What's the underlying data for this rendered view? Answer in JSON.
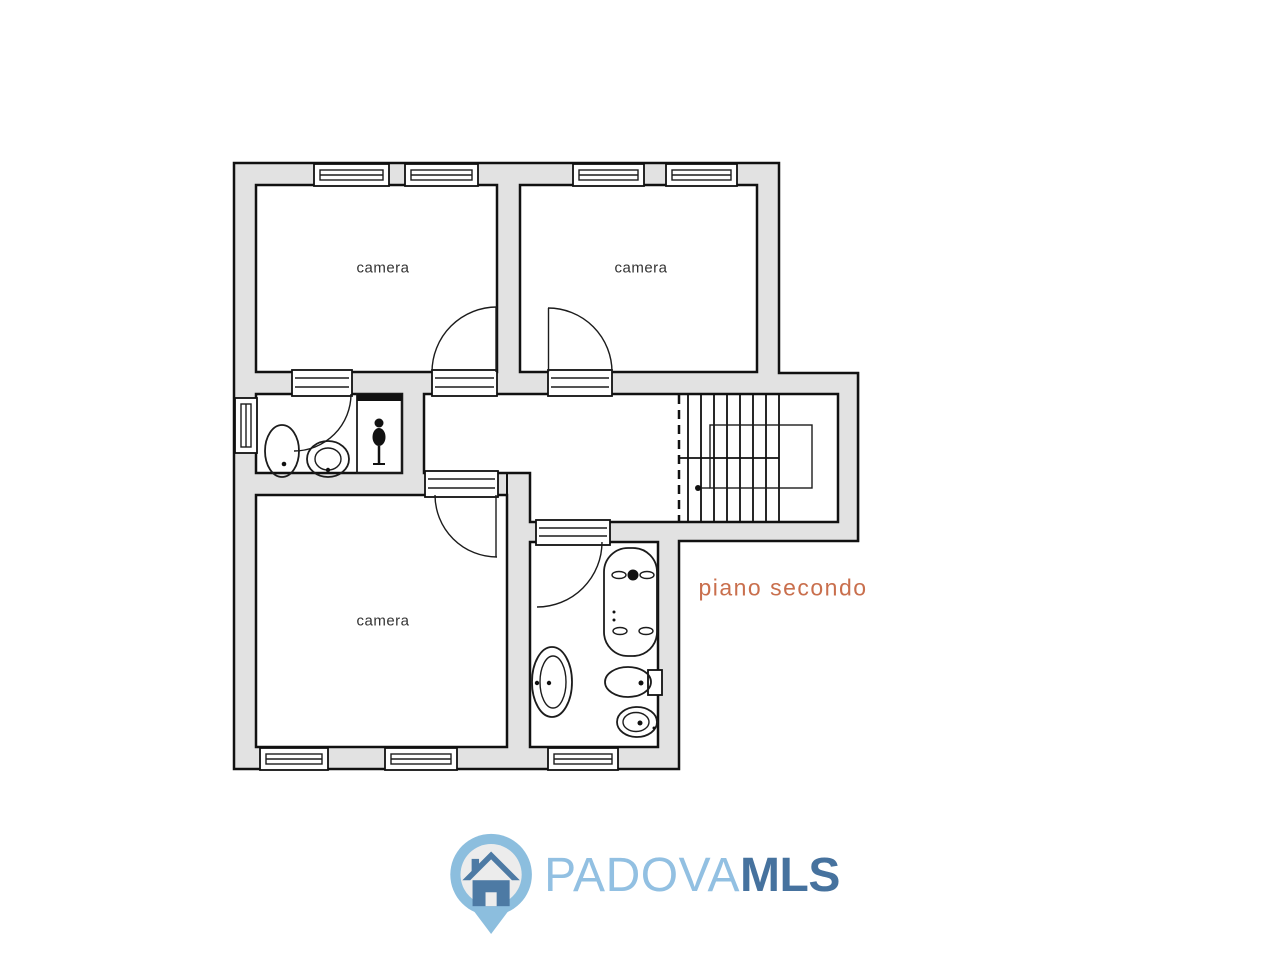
{
  "plan": {
    "floor_label": "piano secondo",
    "rooms": [
      {
        "name": "camera-top-left",
        "label": "camera"
      },
      {
        "name": "camera-top-right",
        "label": "camera"
      },
      {
        "name": "camera-bottom-left",
        "label": "camera"
      }
    ],
    "unlabeled_spaces": [
      "bathroom-top",
      "bathroom-bottom",
      "hallway",
      "staircase"
    ],
    "colors": {
      "wall_fill": "#e2e2e2",
      "outline": "#111111",
      "floor_label_color": "#c96f4d"
    }
  },
  "logo": {
    "brand_primary": "PADOVA",
    "brand_secondary": "MLS",
    "icon": "house-pin-icon",
    "colors": {
      "pin": "#8cbede",
      "pin_inner": "#ececec",
      "house": "#4d7aa4",
      "primary_text": "#92c0e2",
      "secondary_text": "#46729e"
    }
  }
}
